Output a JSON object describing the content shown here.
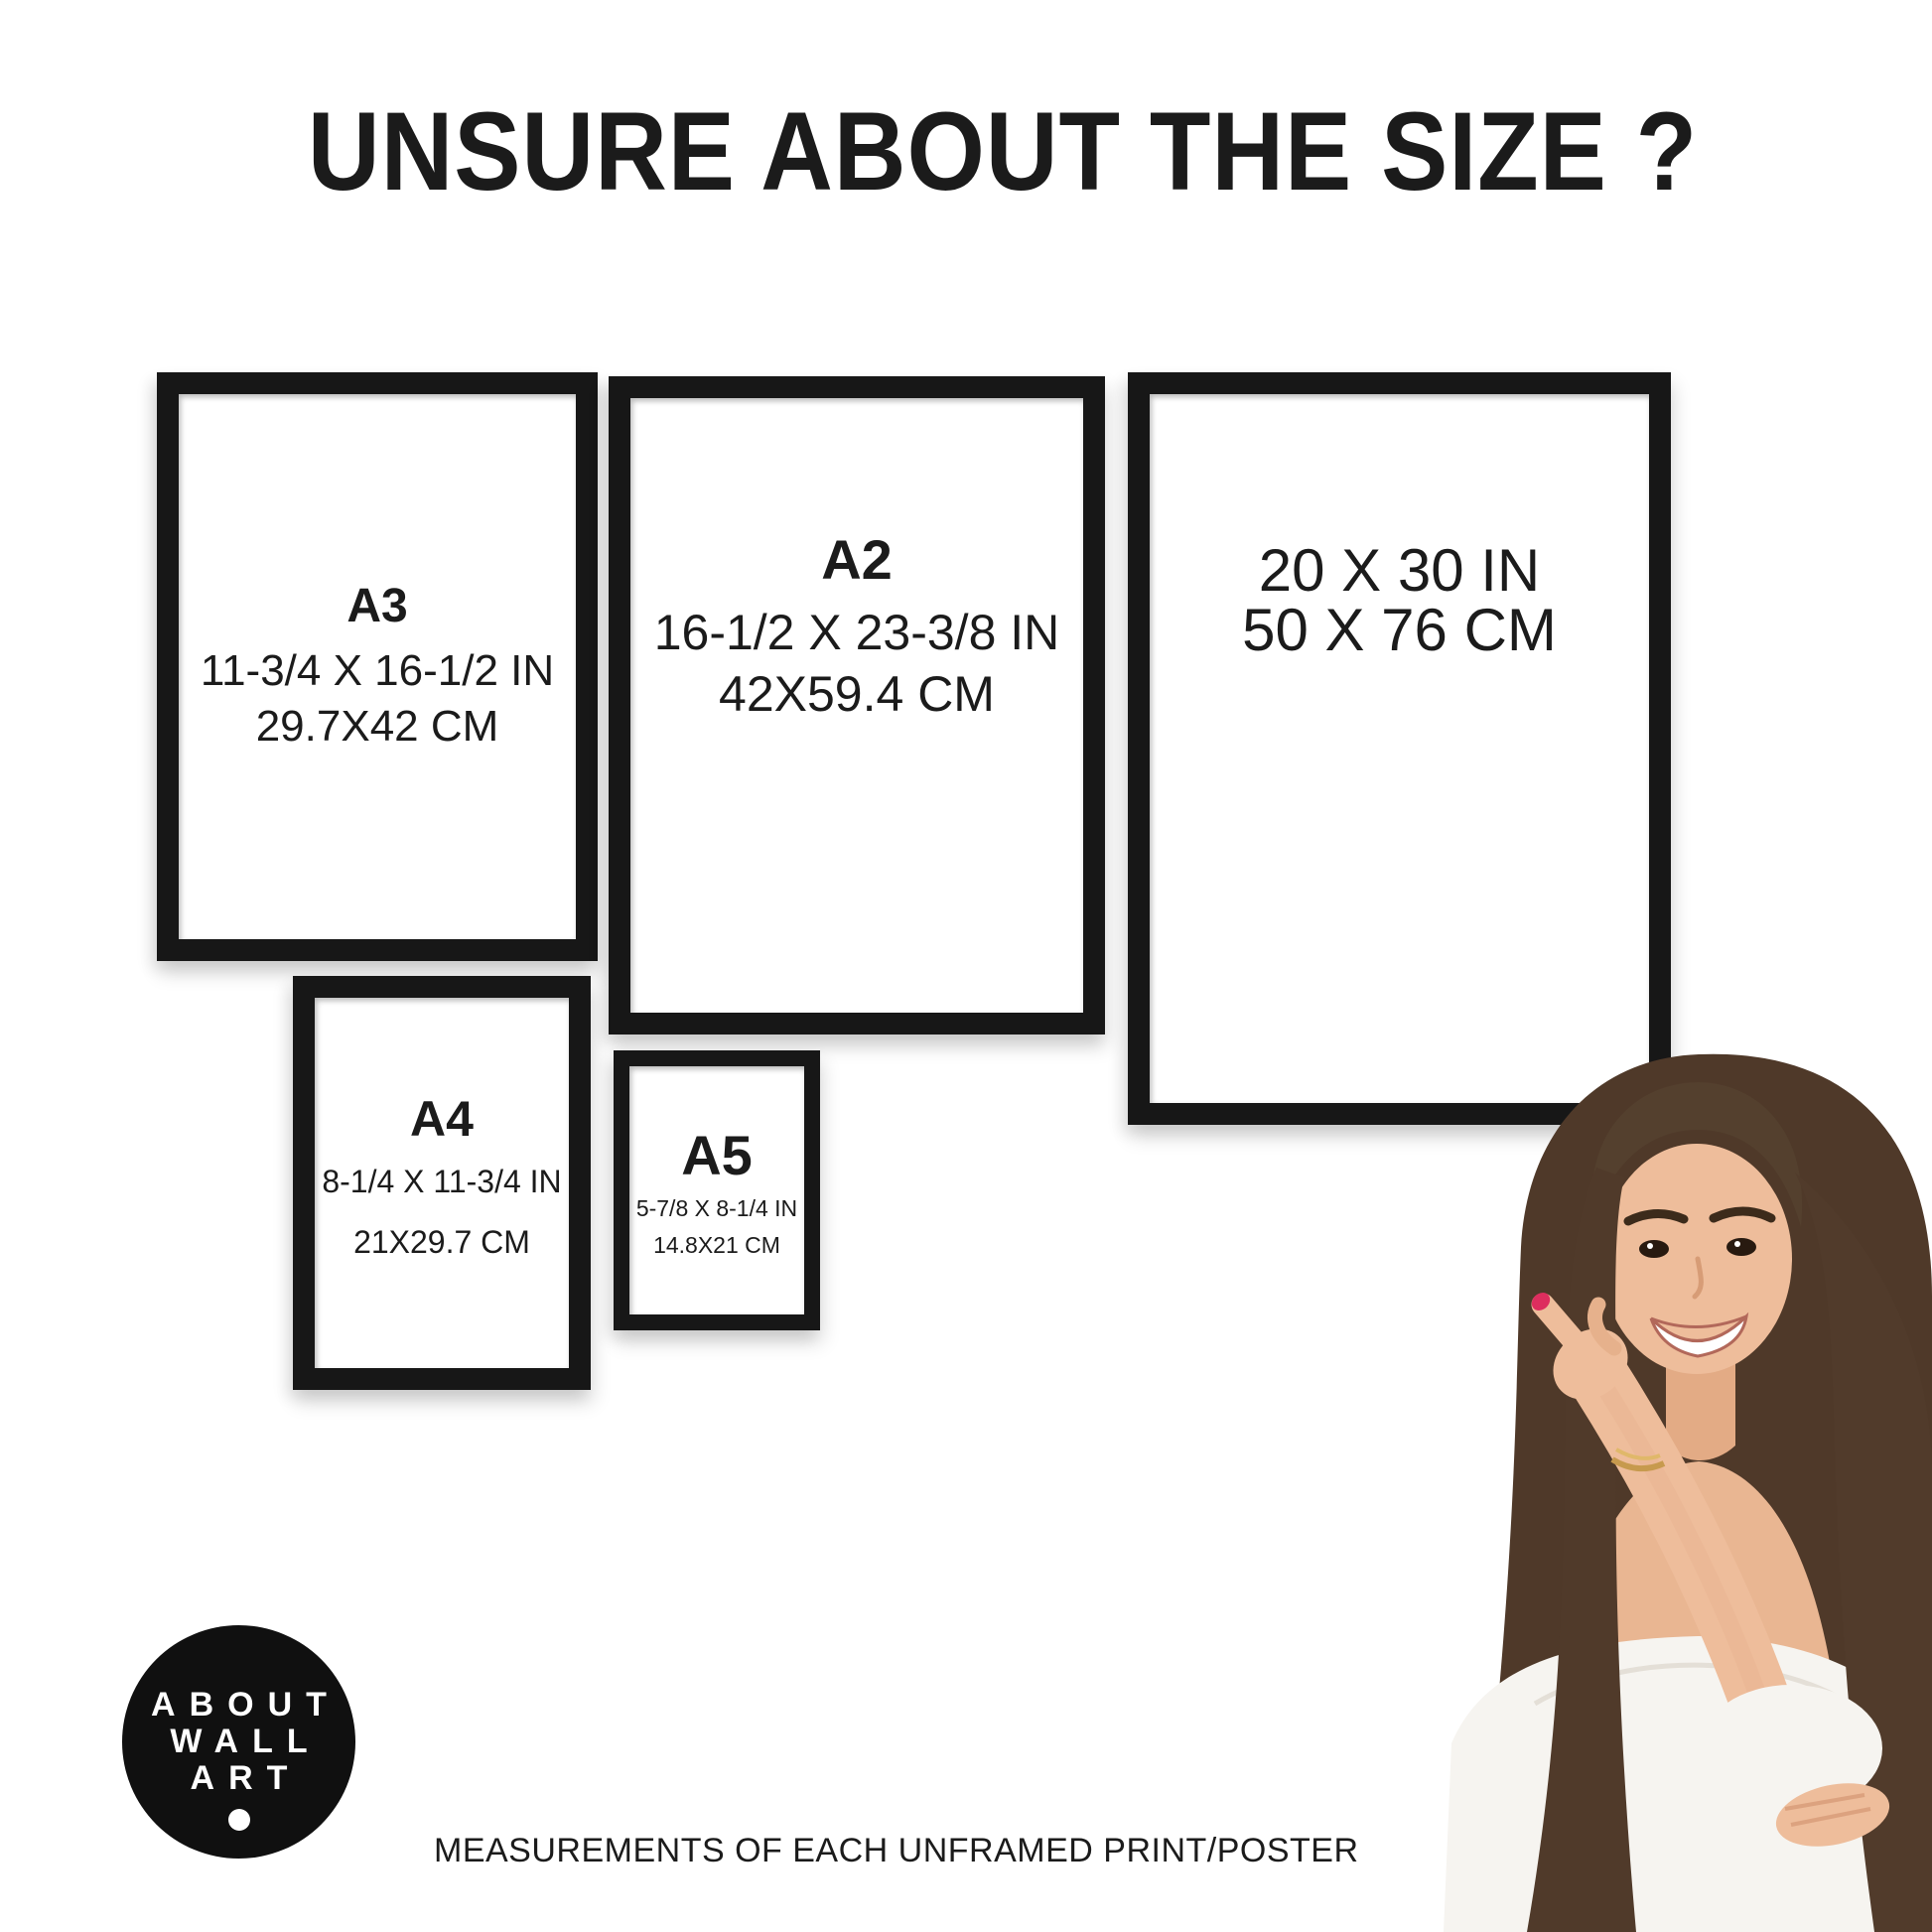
{
  "title": "UNSURE ABOUT THE SIZE ?",
  "frames": [
    {
      "name": "A3",
      "size_label": "A3",
      "inches": "11-3/4 X 16-1/2 IN",
      "cm": "29.7X42 CM"
    },
    {
      "name": "A2",
      "size_label": "A2",
      "inches": "16-1/2 X 23-3/8 IN",
      "cm": "42X59.4 CM"
    },
    {
      "name": "20x30",
      "size_label": "",
      "inches": "20 X 30 IN",
      "cm": "50 X 76 CM"
    },
    {
      "name": "A4",
      "size_label": "A4",
      "inches": "8-1/4 X 11-3/4 IN",
      "cm": "21X29.7 CM"
    },
    {
      "name": "A5",
      "size_label": "A5",
      "inches": "5-7/8 X 8-1/4 IN",
      "cm": "14.8X21 CM"
    }
  ],
  "logo": {
    "words": [
      "ABOUT",
      "WALL",
      "ART"
    ]
  },
  "caption": "MEASUREMENTS OF EACH UNFRAMED PRINT/POSTER",
  "colors": {
    "background": "#ffffff",
    "frame": "#171717",
    "text": "#1b1b1b",
    "logo_background": "#101010",
    "logo_text": "#ffffff",
    "nail_polish": "#dd2e5e",
    "hair": "#4f3929",
    "skin": "#eebd9b",
    "blouse": "#f6f4f0"
  }
}
